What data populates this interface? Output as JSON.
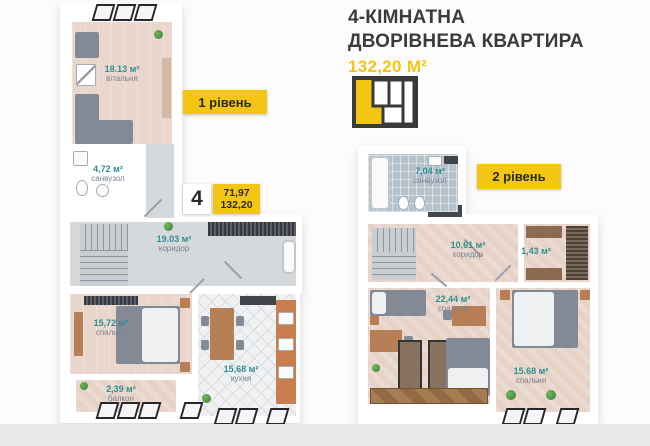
{
  "header": {
    "title_line1": "4-КІМНАТНА",
    "title_line2": "ДВОРІВНЕВА КВАРТИРА",
    "total_area": "132,20 М²"
  },
  "badges": {
    "level1_label": "1 рівень",
    "level2_label": "2 рівень",
    "rooms_count": "4",
    "living_area": "71,97",
    "total_area": "132,20"
  },
  "level1": {
    "rooms": [
      {
        "area": "18.13 м²",
        "name": "вітальня"
      },
      {
        "area": "4,72 м²",
        "name": "санвузол"
      },
      {
        "area": "19.03 м²",
        "name": "коридор"
      },
      {
        "area": "15,72 м²",
        "name": "спальня"
      },
      {
        "area": "2,39 м²",
        "name": "балкон"
      },
      {
        "area": "15,68 м²",
        "name": "кухня"
      }
    ]
  },
  "level2": {
    "rooms": [
      {
        "area": "7,04 м²",
        "name": "санвузол"
      },
      {
        "area": "10,61 м²",
        "name": "коридор"
      },
      {
        "area": "1,43 м²",
        "name": ""
      },
      {
        "area": "22,44 м²",
        "name": "спальня"
      },
      {
        "area": "15.68 м²",
        "name": "спальня"
      }
    ]
  },
  "colors": {
    "accent_yellow": "#f3c613",
    "area_text_teal": "#2f8f8f",
    "title_text": "#3b3b3d"
  }
}
